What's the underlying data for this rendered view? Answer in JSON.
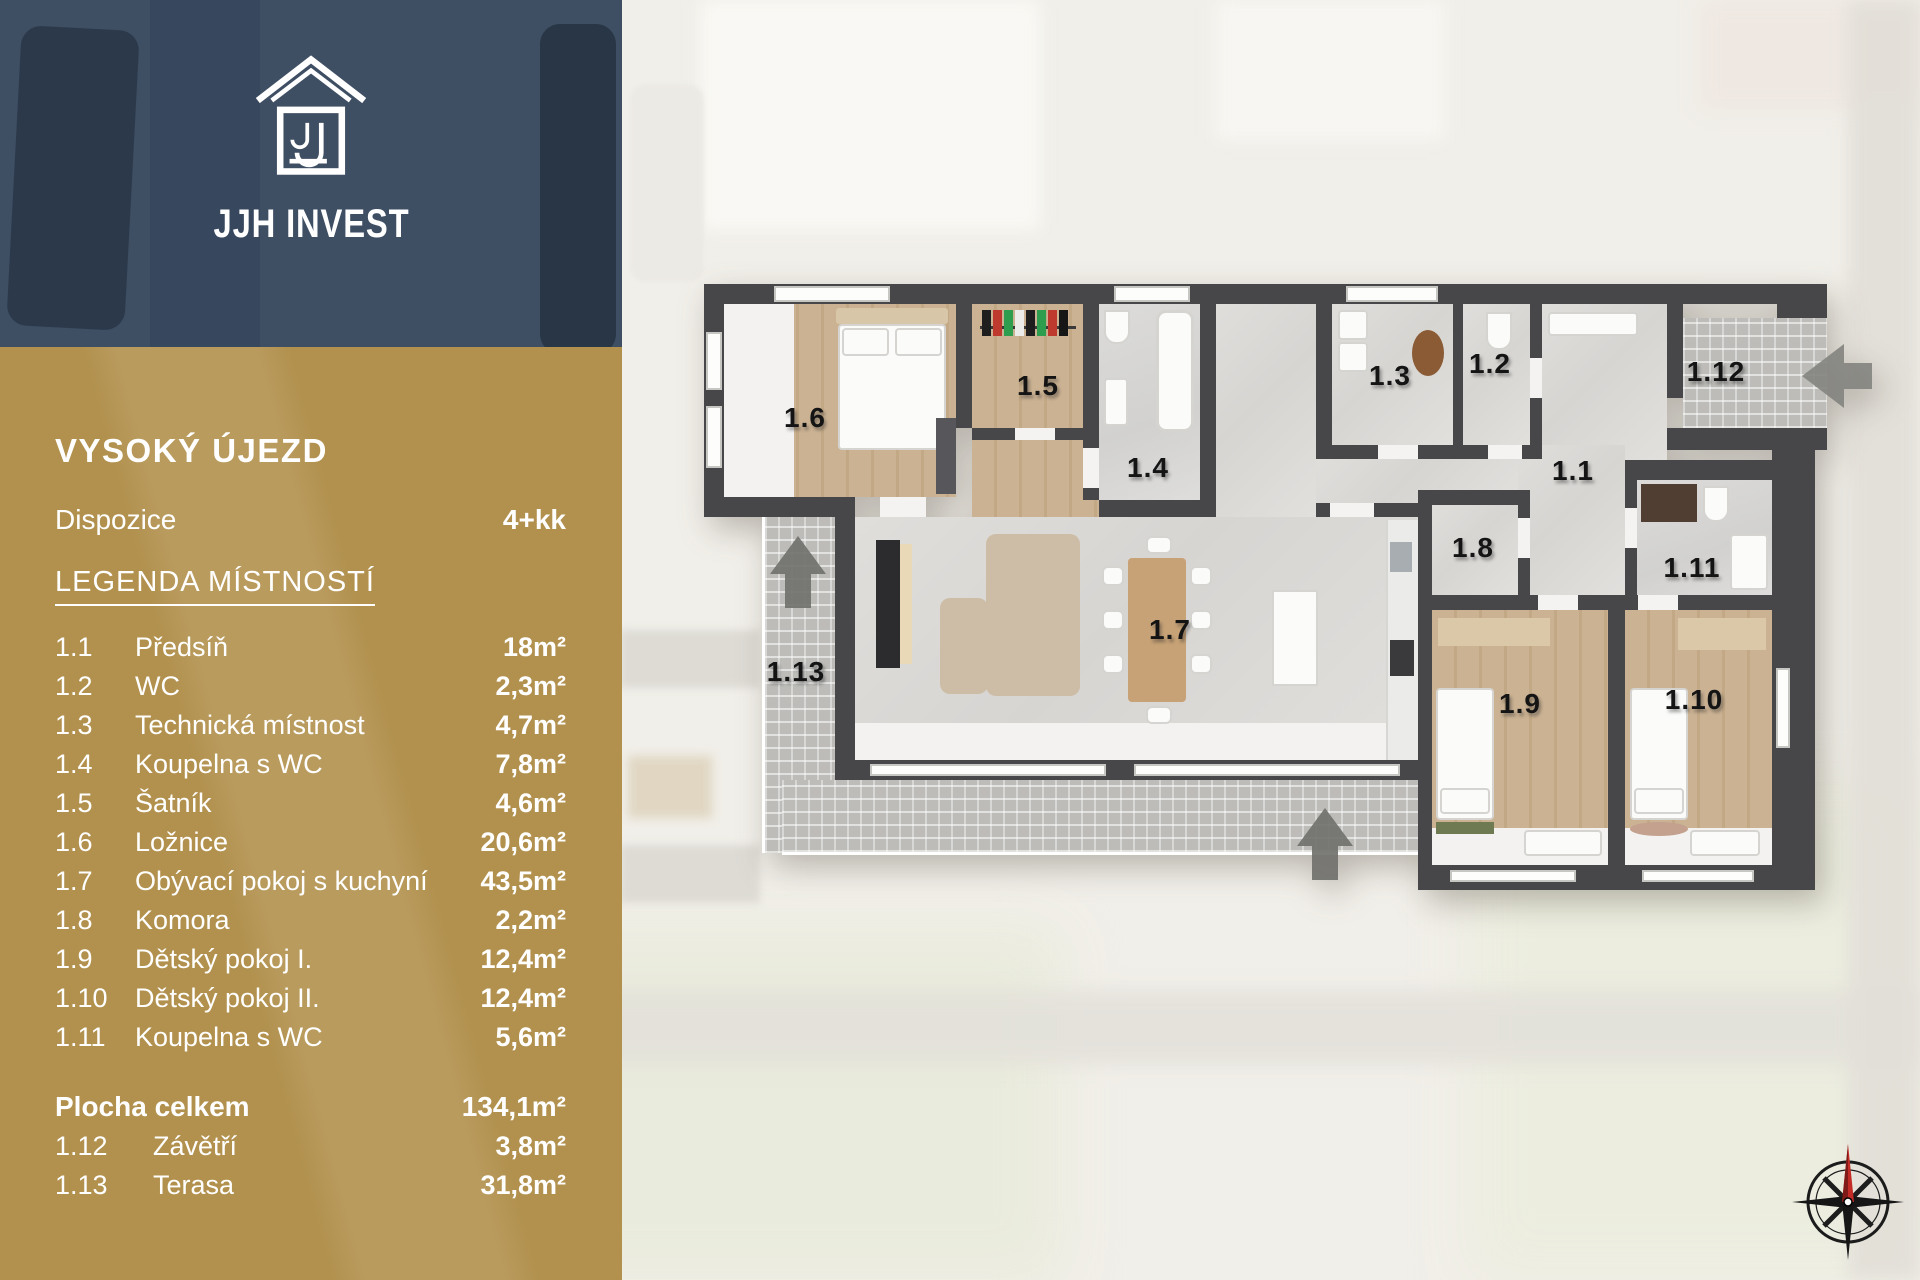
{
  "brand": {
    "logo_text": "JJH INVEST"
  },
  "sidebar": {
    "title": "VYSOKÝ ÚJEZD",
    "dispozice": {
      "label": "Dispozice",
      "value": "4+kk"
    },
    "legend_heading": "LEGENDA MÍSTNOSTÍ",
    "rooms": [
      {
        "id": "1.1",
        "name": "Předsíň",
        "area": "18m²"
      },
      {
        "id": "1.2",
        "name": "WC",
        "area": "2,3m²"
      },
      {
        "id": "1.3",
        "name": "Technická místnost",
        "area": "4,7m²"
      },
      {
        "id": "1.4",
        "name": "Koupelna s WC",
        "area": "7,8m²"
      },
      {
        "id": "1.5",
        "name": "Šatník",
        "area": "4,6m²"
      },
      {
        "id": "1.6",
        "name": "Ložnice",
        "area": "20,6m²"
      },
      {
        "id": "1.7",
        "name": "Obývací pokoj s kuchyní",
        "area": "43,5m²"
      },
      {
        "id": "1.8",
        "name": "Komora",
        "area": "2,2m²"
      },
      {
        "id": "1.9",
        "name": "Dětský pokoj I.",
        "area": "12,4m²"
      },
      {
        "id": "1.10",
        "name": "Dětský pokoj II.",
        "area": "12,4m²"
      },
      {
        "id": "1.11",
        "name": "Koupelna s WC",
        "area": "5,6m²"
      }
    ],
    "total": {
      "label": "Plocha celkem",
      "value": "134,1m²"
    },
    "outdoor": [
      {
        "id": "1.12",
        "name": "Závětří",
        "area": "3,8m²"
      },
      {
        "id": "1.13",
        "name": "Terasa",
        "area": "31,8m²"
      }
    ]
  },
  "plan": {
    "room_labels": [
      "1.1",
      "1.2",
      "1.3",
      "1.4",
      "1.5",
      "1.6",
      "1.7",
      "1.8",
      "1.9",
      "1.10",
      "1.11",
      "1.12",
      "1.13"
    ]
  },
  "colors": {
    "panel_blue": "#3e4e63",
    "panel_gold": "#b2914e",
    "wall": "#474749",
    "compass_red": "#c22b26"
  }
}
